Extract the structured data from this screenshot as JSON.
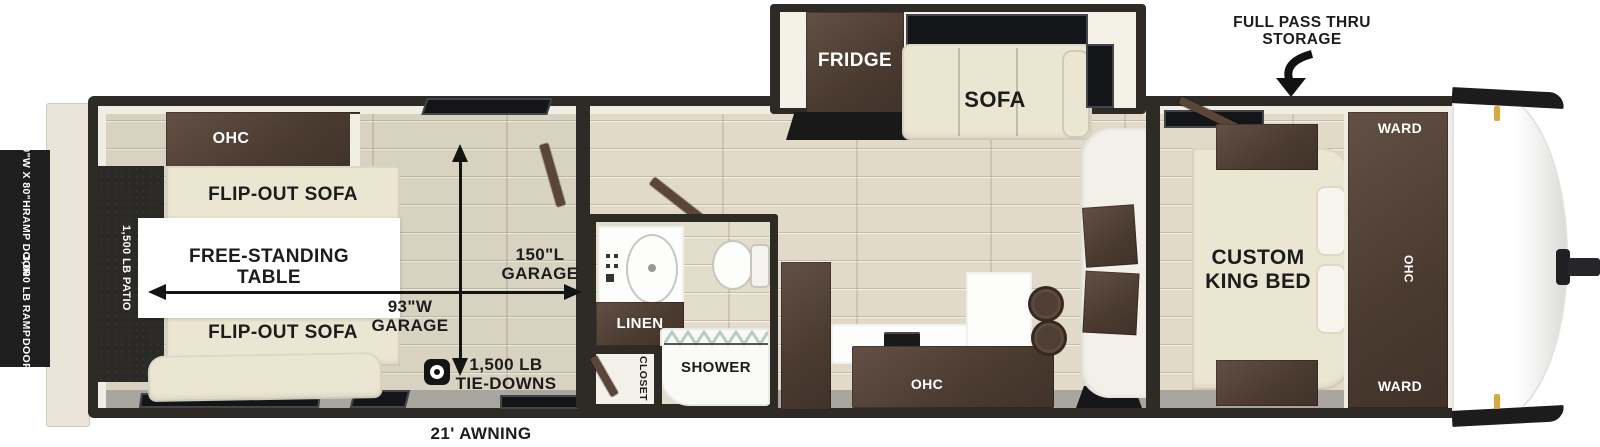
{
  "title": "Toy hauler travel trailer floor plan",
  "exterior": {
    "ramp_size": {
      "line1": "90\"W X 80\"H",
      "line2": "RAMP DOOR"
    },
    "ramp_weight": {
      "line1": "3,000 LB RAMP",
      "line2": "DOOR"
    },
    "storage": {
      "line1": "FULL PASS THRU",
      "line2": "STORAGE"
    },
    "awning": "21' AWNING"
  },
  "garage": {
    "ohc": "OHC",
    "flip_sofa_top": "FLIP-OUT SOFA",
    "flip_sofa_bottom": "FLIP-OUT SOFA",
    "table": {
      "line1": "FREE-STANDING",
      "line2": "TABLE"
    },
    "patio": "1,500 LB PATIO",
    "length": {
      "line1": "150\"L",
      "line2": "GARAGE"
    },
    "width": {
      "line1": "93\"W",
      "line2": "GARAGE"
    },
    "tie_downs": {
      "line1": "1,500 LB",
      "line2": "TIE-DOWNS"
    }
  },
  "living": {
    "fridge": "FRIDGE",
    "sofa": "SOFA",
    "kitchen_ohc": "OHC"
  },
  "bathroom": {
    "linen": "LINEN",
    "shower": "SHOWER",
    "closet": "CLOSET"
  },
  "bedroom": {
    "bed": {
      "line1": "CUSTOM",
      "line2": "KING BED"
    },
    "ward_top": "WARD",
    "ward_bottom": "WARD",
    "ohc": "OHC"
  },
  "colors": {
    "cabinet_brown": "#4a3a30",
    "cream": "#ebe6d2",
    "wall_dark": "#2e2a25",
    "floor_wood": "#d8d2c1",
    "marker_gold": "#d9a93f"
  }
}
